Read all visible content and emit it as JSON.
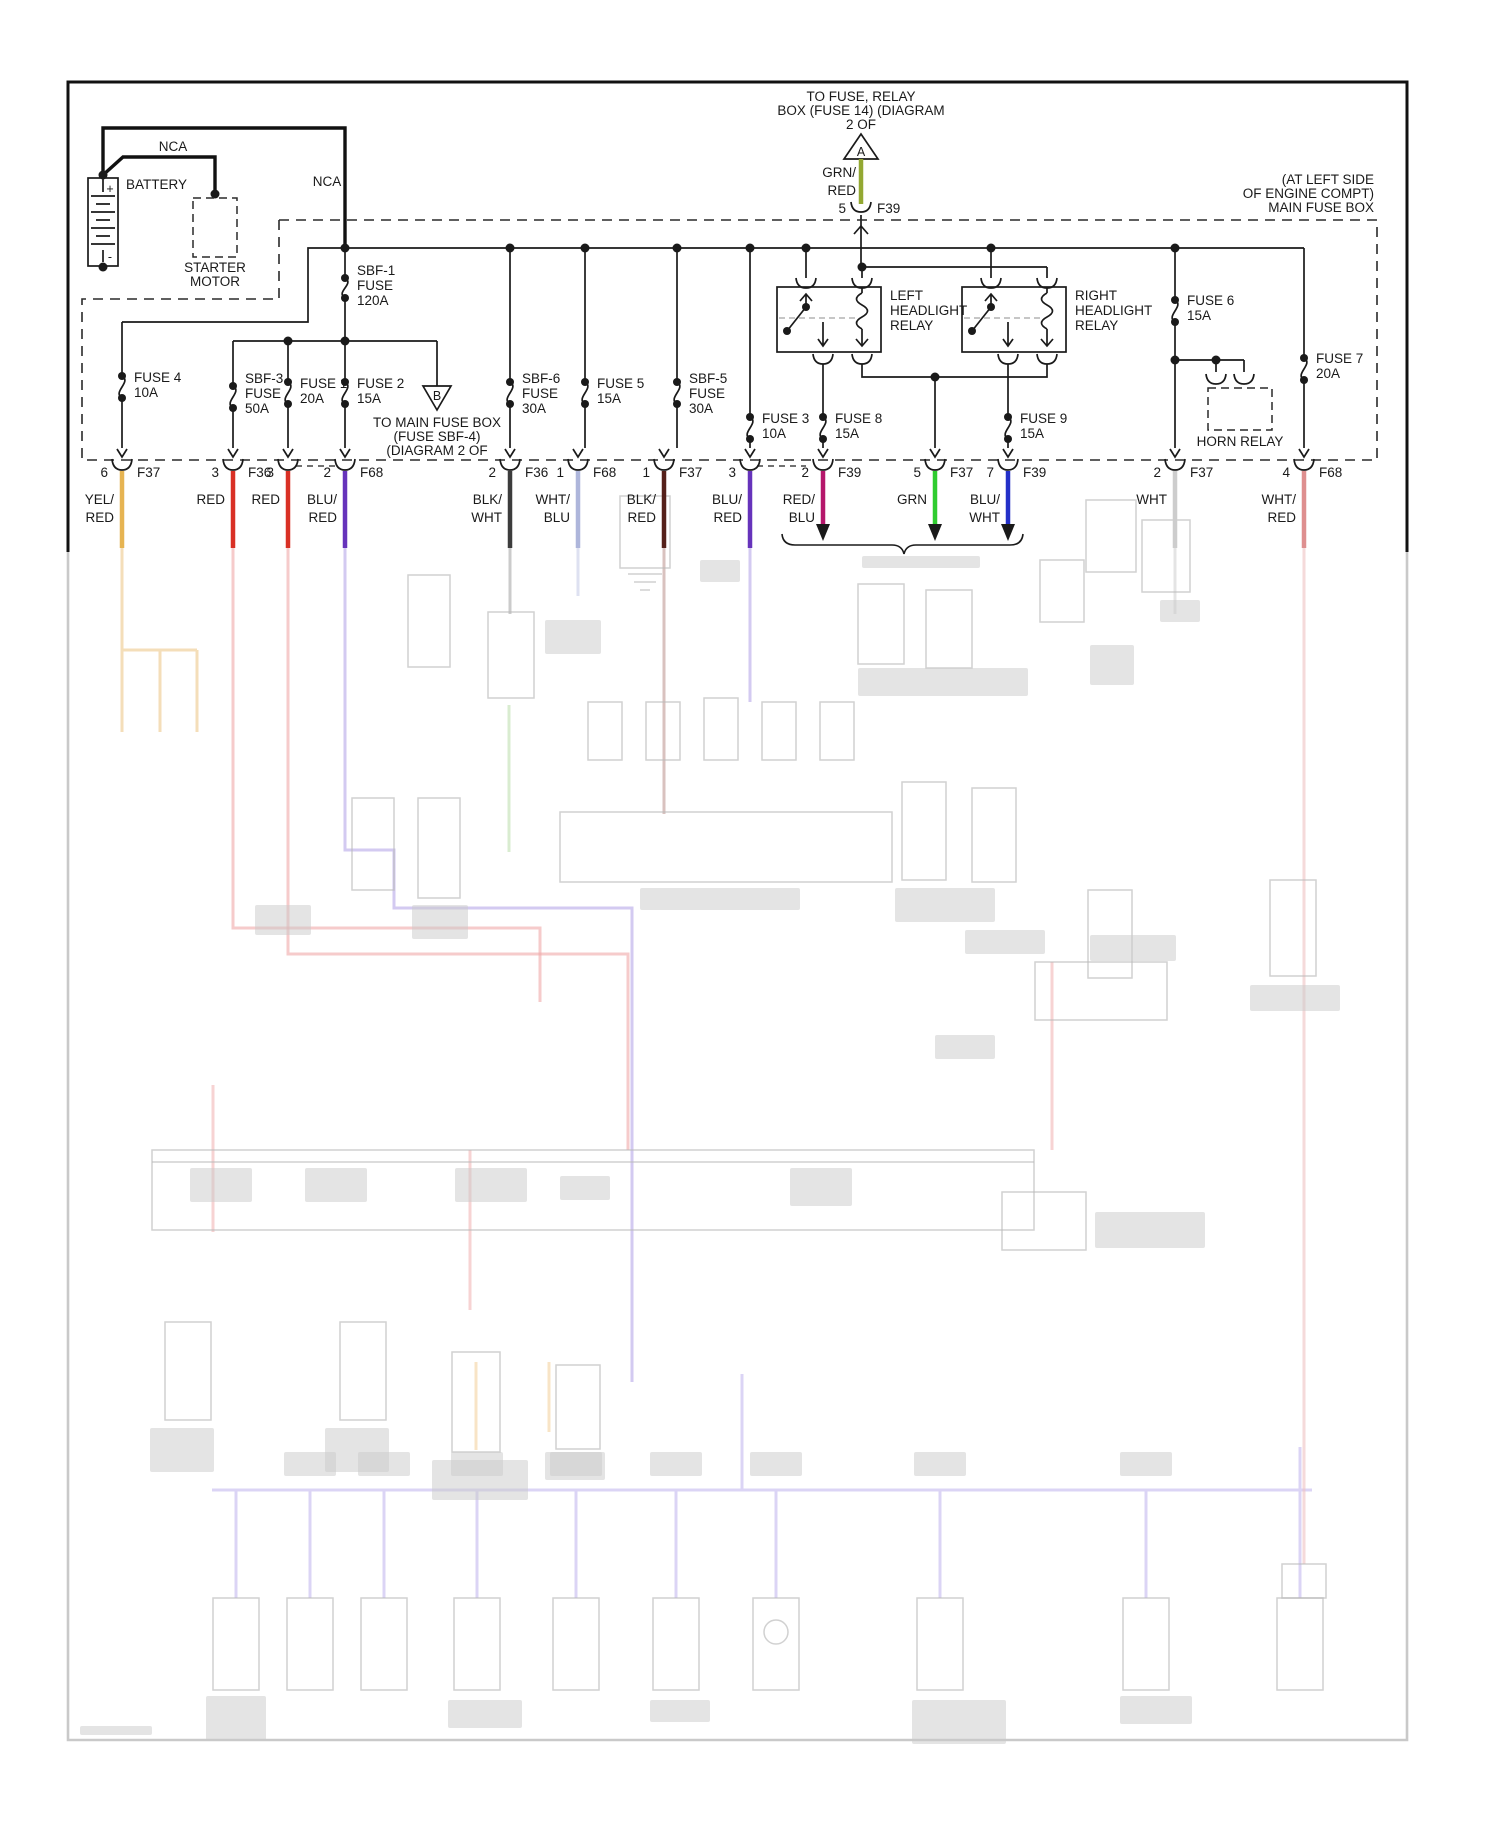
{
  "diagram": {
    "title_note": {
      "lines": [
        "TO FUSE, RELAY",
        "BOX (FUSE 14) (DIAGRAM",
        "2 OF"
      ],
      "tag": "A"
    },
    "feed_wire": {
      "color_lines": [
        "GRN/",
        "RED"
      ],
      "pin": "5",
      "cavity": "F39",
      "color": "#93A832"
    },
    "location_note": {
      "lines": [
        "(AT LEFT SIDE",
        "OF ENGINE COMPT)",
        "MAIN FUSE BOX"
      ]
    },
    "battery": {
      "label": "BATTERY",
      "plus": "+",
      "minus": "-"
    },
    "nca_left": "NCA",
    "nca_right": "NCA",
    "starter_motor": {
      "lines": [
        "STARTER",
        "MOTOR"
      ]
    },
    "sub_branch": {
      "tag": "B",
      "lines": [
        "TO MAIN FUSE BOX",
        "(FUSE SBF-4)",
        "(DIAGRAM 2 OF"
      ]
    },
    "relays": {
      "left": {
        "lines": [
          "LEFT",
          "HEADLIGHT",
          "RELAY"
        ]
      },
      "right": {
        "lines": [
          "RIGHT",
          "HEADLIGHT",
          "RELAY"
        ]
      },
      "horn": {
        "label": "HORN RELAY"
      }
    },
    "fuses": [
      {
        "id": "sbf-1",
        "x": 345,
        "y1": 278,
        "y2": 298,
        "lx": 357,
        "ly": 275,
        "label": [
          "SBF-1",
          "FUSE",
          "120A"
        ]
      },
      {
        "id": "fuse-4",
        "x": 122,
        "y1": 376,
        "y2": 398,
        "lx": 134,
        "ly": 382,
        "label": [
          "FUSE 4",
          "10A"
        ]
      },
      {
        "id": "sbf-3",
        "x": 233,
        "y1": 386,
        "y2": 408,
        "lx": 245,
        "ly": 383,
        "label": [
          "SBF-3",
          "FUSE",
          "50A"
        ]
      },
      {
        "id": "fuse-1",
        "x": 288,
        "y1": 382,
        "y2": 404,
        "lx": 300,
        "ly": 388,
        "label": [
          "FUSE 1",
          "20A"
        ]
      },
      {
        "id": "fuse-2",
        "x": 345,
        "y1": 382,
        "y2": 404,
        "lx": 357,
        "ly": 388,
        "label": [
          "FUSE 2",
          "15A"
        ]
      },
      {
        "id": "sbf-6",
        "x": 510,
        "y1": 382,
        "y2": 404,
        "lx": 522,
        "ly": 383,
        "label": [
          "SBF-6",
          "FUSE",
          "30A"
        ]
      },
      {
        "id": "fuse-5",
        "x": 585,
        "y1": 382,
        "y2": 404,
        "lx": 597,
        "ly": 388,
        "label": [
          "FUSE 5",
          "15A"
        ]
      },
      {
        "id": "sbf-5",
        "x": 677,
        "y1": 382,
        "y2": 404,
        "lx": 689,
        "ly": 383,
        "label": [
          "SBF-5",
          "FUSE",
          "30A"
        ]
      },
      {
        "id": "fuse-3",
        "x": 750,
        "y1": 417,
        "y2": 439,
        "lx": 762,
        "ly": 423,
        "label": [
          "FUSE 3",
          "10A"
        ]
      },
      {
        "id": "fuse-8",
        "x": 823,
        "y1": 417,
        "y2": 439,
        "lx": 835,
        "ly": 423,
        "label": [
          "FUSE 8",
          "15A"
        ]
      },
      {
        "id": "fuse-9",
        "x": 1008,
        "y1": 417,
        "y2": 439,
        "lx": 1020,
        "ly": 423,
        "label": [
          "FUSE 9",
          "15A"
        ]
      },
      {
        "id": "fuse-6",
        "x": 1175,
        "y1": 300,
        "y2": 322,
        "lx": 1187,
        "ly": 305,
        "label": [
          "FUSE 6",
          "15A"
        ]
      },
      {
        "id": "fuse-7",
        "x": 1304,
        "y1": 358,
        "y2": 380,
        "lx": 1316,
        "ly": 363,
        "label": [
          "FUSE 7",
          "20A"
        ]
      }
    ],
    "connectors": [
      {
        "id": "c1",
        "x": 122,
        "pin": "6",
        "cavity": "F37",
        "color": "#E6B452",
        "color_lines": [
          "YEL/",
          "RED"
        ],
        "arrow": false
      },
      {
        "id": "c2",
        "x": 233,
        "pin": "3",
        "cavity": "F36",
        "color": "#D93025",
        "color_lines": [
          "RED"
        ],
        "arrow": false
      },
      {
        "id": "c3",
        "x": 288,
        "pin": "3",
        "cavity": "",
        "color": "#D93025",
        "color_lines": [
          "RED"
        ],
        "arrow": false
      },
      {
        "id": "c4",
        "x": 345,
        "pin": "2",
        "cavity": "F68",
        "color": "#6633BB",
        "color_lines": [
          "BLU/",
          "RED"
        ],
        "arrow": false
      },
      {
        "id": "c5",
        "x": 510,
        "pin": "2",
        "cavity": "F36",
        "color": "#3C3C3C",
        "color_lines": [
          "BLK/",
          "WHT"
        ],
        "arrow": false
      },
      {
        "id": "c6",
        "x": 578,
        "pin": "1",
        "cavity": "F68",
        "color": "#AEB6DB",
        "color_lines": [
          "WHT/",
          "BLU"
        ],
        "arrow": false
      },
      {
        "id": "c7",
        "x": 664,
        "pin": "1",
        "cavity": "F37",
        "color": "#55201A",
        "color_lines": [
          "BLK/",
          "RED"
        ],
        "arrow": false
      },
      {
        "id": "c8",
        "x": 750,
        "pin": "3",
        "cavity": "",
        "color": "#6633BB",
        "color_lines": [
          "BLU/",
          "RED"
        ],
        "arrow": false
      },
      {
        "id": "c9",
        "x": 823,
        "pin": "2",
        "cavity": "F39",
        "color": "#B5176B",
        "color_lines": [
          "RED/",
          "BLU"
        ],
        "arrow": true
      },
      {
        "id": "c10",
        "x": 935,
        "pin": "5",
        "cavity": "F37",
        "color": "#2FCC2F",
        "color_lines": [
          "GRN"
        ],
        "arrow": true
      },
      {
        "id": "c11",
        "x": 1008,
        "pin": "7",
        "cavity": "F39",
        "color": "#2430C8",
        "color_lines": [
          "BLU/",
          "WHT"
        ],
        "arrow": true
      },
      {
        "id": "c12",
        "x": 1175,
        "pin": "2",
        "cavity": "F37",
        "color": "#CDCDCD",
        "color_lines": [
          "WHT"
        ],
        "arrow": false
      },
      {
        "id": "c13",
        "x": 1304,
        "pin": "4",
        "cavity": "F68",
        "color": "#DE8F8F",
        "color_lines": [
          "WHT/",
          "RED"
        ],
        "arrow": false
      }
    ]
  }
}
